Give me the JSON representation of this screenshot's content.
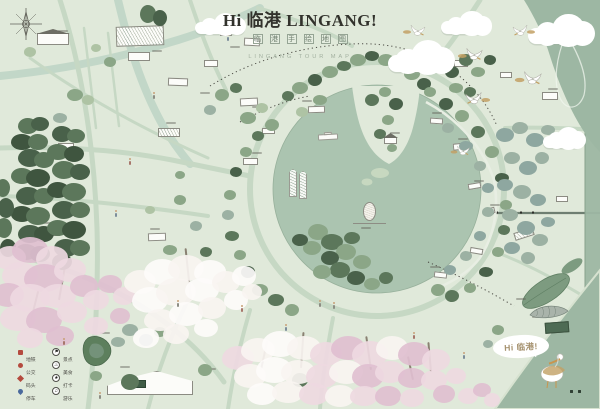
{
  "title": {
    "main": "Hi 临港 LINGANG!",
    "seal_chars": [
      "临",
      "港",
      "手",
      "绘",
      "地",
      "图"
    ],
    "caption": "LINGANG TOUR MAP"
  },
  "speech_bubble": {
    "text": "Hi 临港!"
  },
  "legend": {
    "left": [
      {
        "icon": "metro-icon",
        "label": "地铁"
      },
      {
        "icon": "bus-icon",
        "label": "公交"
      },
      {
        "icon": "dock-icon",
        "label": "码头"
      },
      {
        "icon": "parking-icon",
        "label": "停车"
      }
    ],
    "right": [
      {
        "icon": "scenic-icon",
        "glyph": "⚑",
        "label": "景点"
      },
      {
        "icon": "food-icon",
        "glyph": "♨",
        "label": "美食"
      },
      {
        "icon": "photo-icon",
        "glyph": "★",
        "label": "打卡"
      },
      {
        "icon": "fun-icon",
        "glyph": "♫",
        "label": "游乐"
      }
    ]
  },
  "colors": {
    "background": "#e0e9da",
    "road": "#c6d8c4",
    "canal": "#c2d7c8",
    "lake": "#abc4b0",
    "sea": "#9db7a3",
    "sea_edge": "#8aa590",
    "ink": "#45453f",
    "title": "#32322c",
    "seal": "#95a494",
    "caption": "#a3b1a0",
    "red": "#b44a3e",
    "blue": "#49699c",
    "tan": "#c2a064",
    "line": "#8b8b82",
    "pine": "#5c775b",
    "pine_dark": "#49614a",
    "pine_deep": "#3f553f",
    "tree_mid": "#8ba687",
    "tree_light": "#aec3a4",
    "tree_gray": "#9cb1a3",
    "tree_blue": "#8ea7a0",
    "blossom": "#eed9e1",
    "blossom_deep": "#e0bfd0",
    "blossom_white": "#f8f4f1",
    "bubble_text": "#a5916e",
    "dark_house": "#4e6b54",
    "whale": "#a9b3aa",
    "leaf_island": "#7d9b80",
    "minimap": "#5d7f5d"
  }
}
